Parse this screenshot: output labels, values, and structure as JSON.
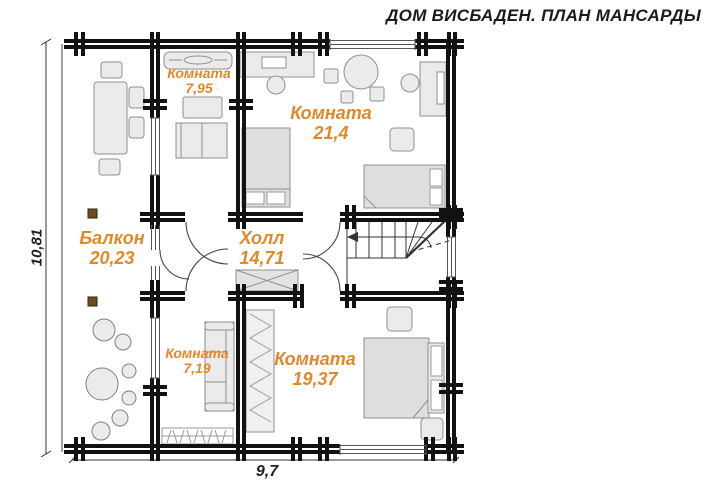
{
  "title": "ДОМ ВИСБАДЕН. ПЛАН МАНСАРДЫ",
  "rooms": {
    "room_795": {
      "label": "Комната",
      "area": "7,95"
    },
    "room_214": {
      "label": "Комната",
      "area": "21,4"
    },
    "balcony": {
      "label": "Балкон",
      "area": "20,23"
    },
    "hall": {
      "label": "Холл",
      "area": "14,71"
    },
    "room_719": {
      "label": "Комната",
      "area": "7,19"
    },
    "room_1937": {
      "label": "Комната",
      "area": "19,37"
    }
  },
  "dimensions": {
    "height": "10,81",
    "width": "9,7"
  },
  "colors": {
    "room_label": "#e0892b",
    "walls": "#121212",
    "furniture": "#ebebeb",
    "wood_accent": "#6b4d1e"
  }
}
